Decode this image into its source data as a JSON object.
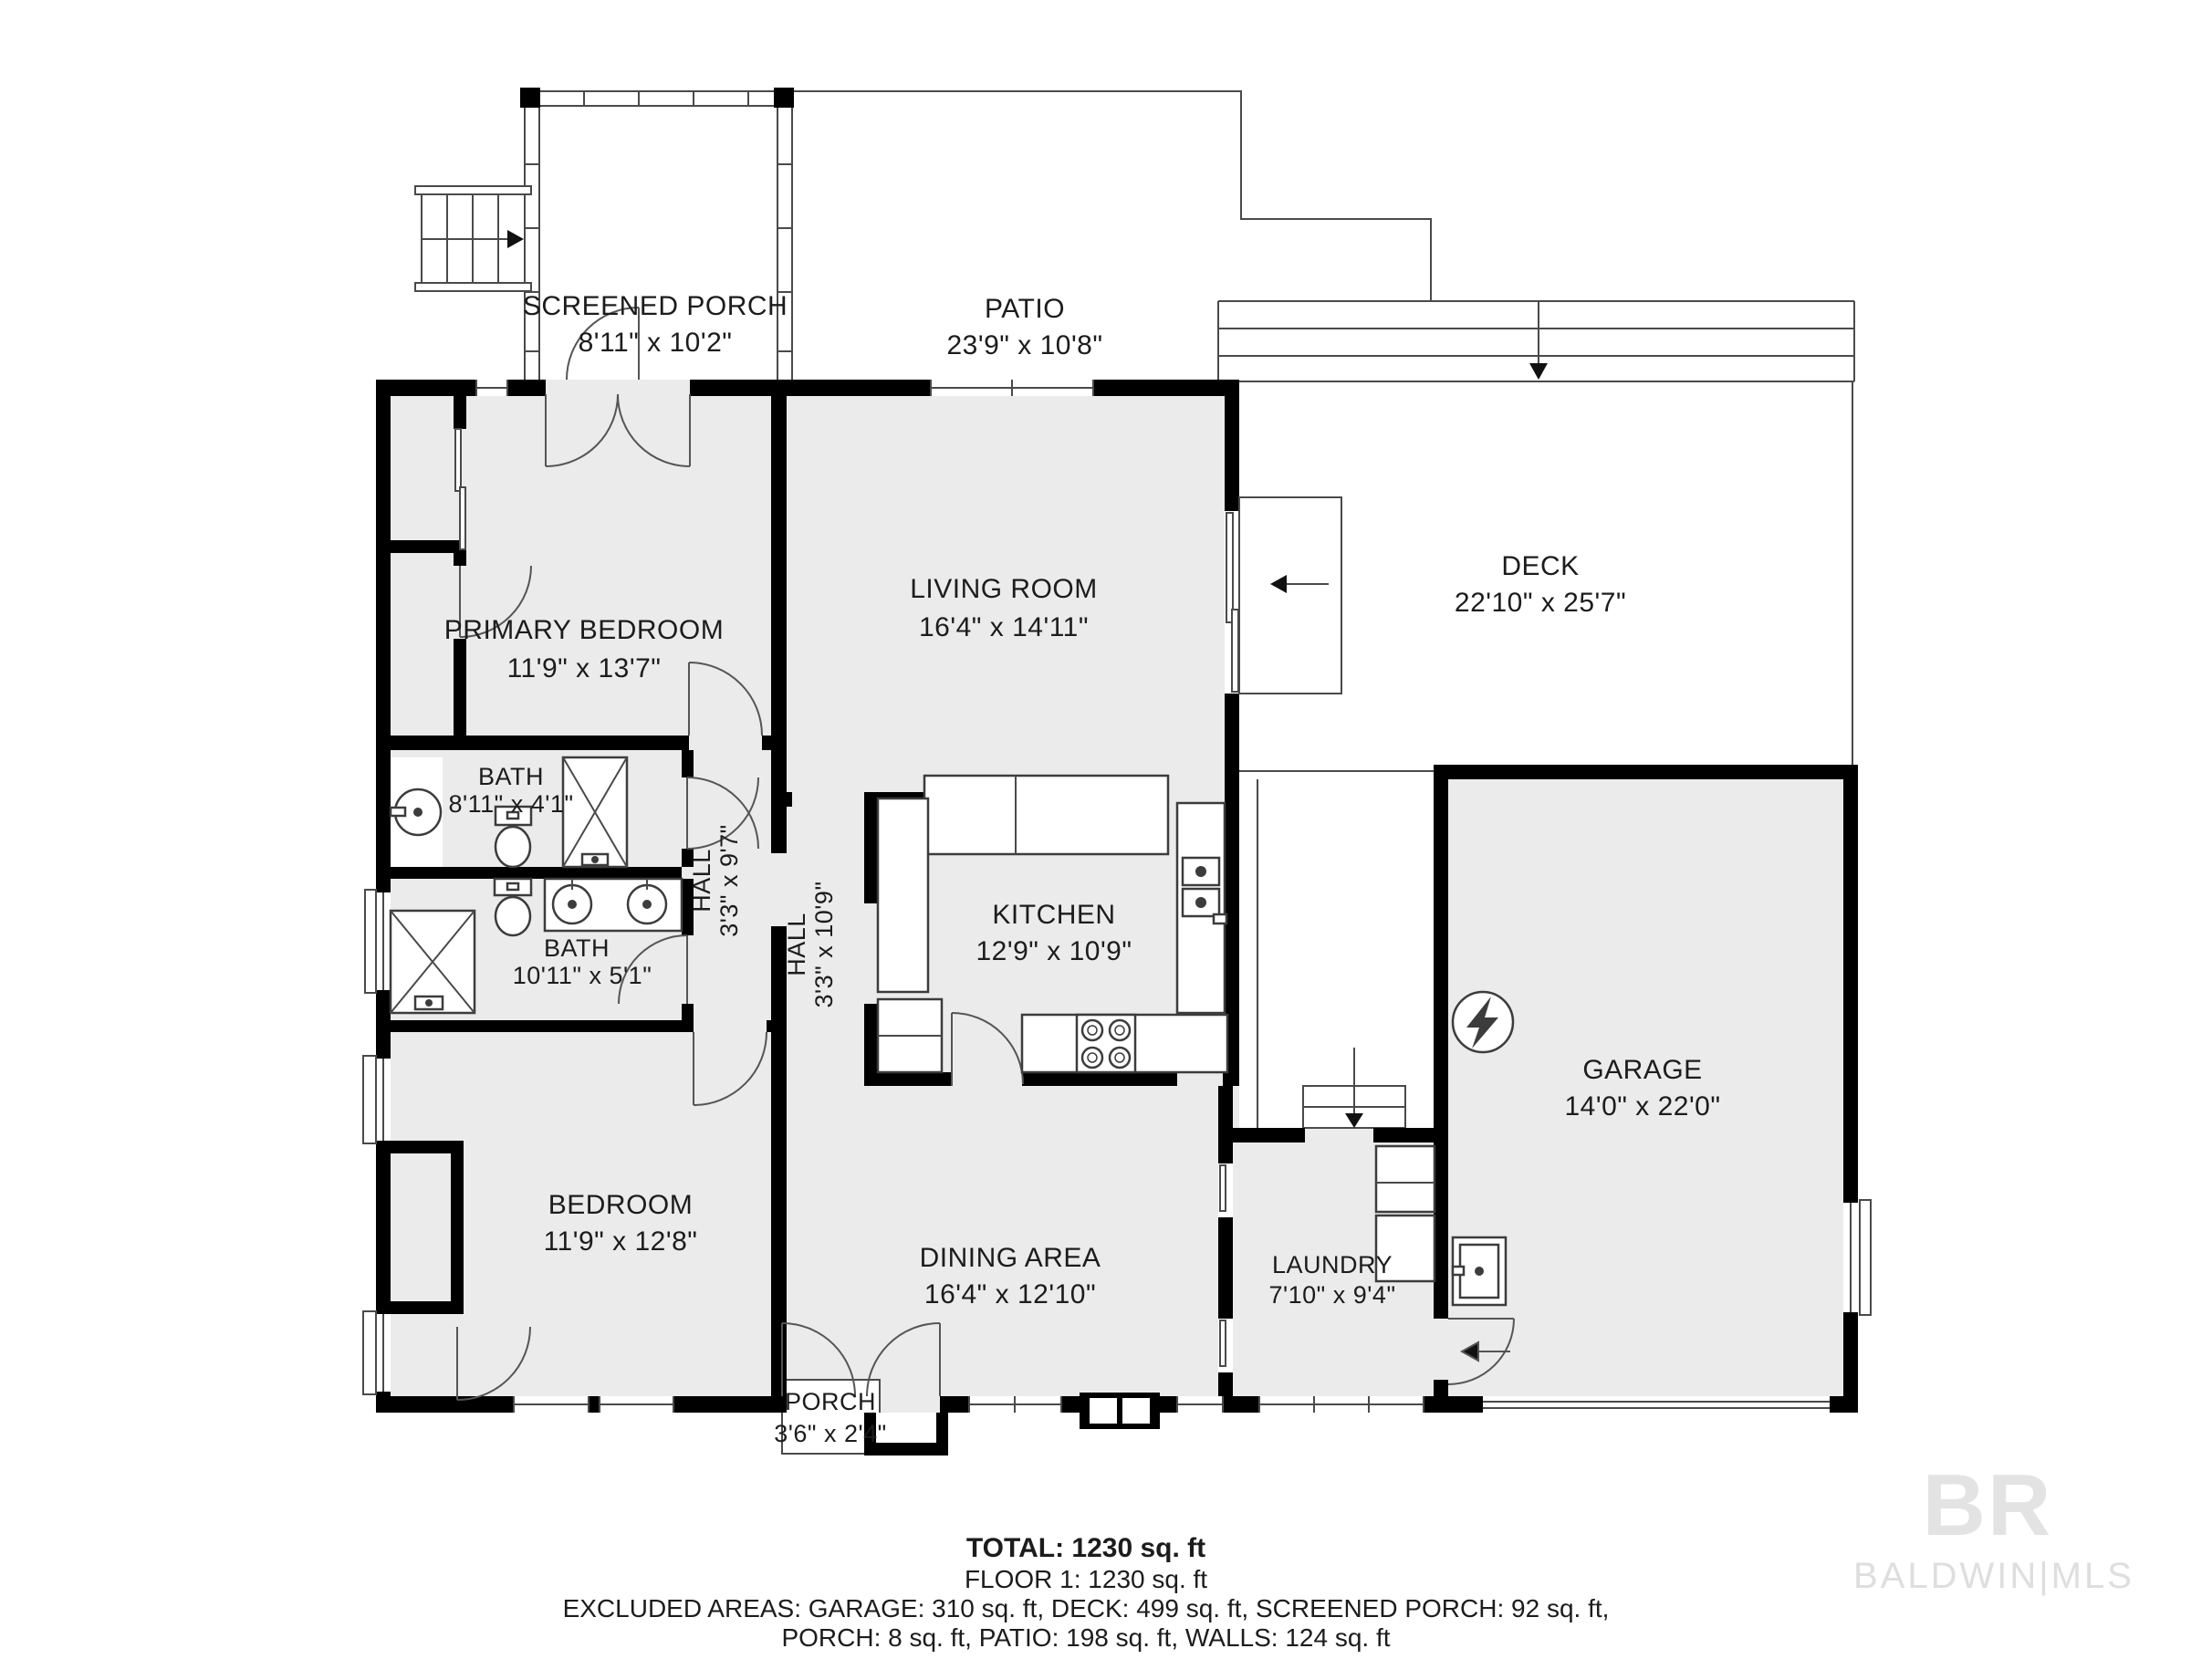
{
  "title": "Floor plan - Floor 1",
  "colors": {
    "wall": "#000000",
    "room_fill": "#ebebeb",
    "line": "#4a4a4a",
    "text": "#1c1c1c",
    "logo": "#e0e0e0",
    "background": "#ffffff"
  },
  "rooms": {
    "screened_porch": {
      "name": "SCREENED PORCH",
      "dims": "8'11\" x 10'2\""
    },
    "patio": {
      "name": "PATIO",
      "dims": "23'9\" x 10'8\""
    },
    "primary_bedroom": {
      "name": "PRIMARY BEDROOM",
      "dims": "11'9\" x 13'7\""
    },
    "living_room": {
      "name": "LIVING ROOM",
      "dims": "16'4\" x 14'11\""
    },
    "deck": {
      "name": "DECK",
      "dims": "22'10\" x 25'7\""
    },
    "bath_top": {
      "name": "BATH",
      "dims": "8'11\" x 4'1\""
    },
    "hall_upper": {
      "name": "HALL",
      "dims": "3'3\" x 9'7\""
    },
    "bath_lower": {
      "name": "BATH",
      "dims": "10'11\" x 5'1\""
    },
    "hall_lower": {
      "name": "HALL",
      "dims": "3'3\" x 10'9\""
    },
    "kitchen": {
      "name": "KITCHEN",
      "dims": "12'9\" x 10'9\""
    },
    "garage": {
      "name": "GARAGE",
      "dims": "14'0\" x 22'0\""
    },
    "bedroom": {
      "name": "BEDROOM",
      "dims": "11'9\" x 12'8\""
    },
    "dining_area": {
      "name": "DINING AREA",
      "dims": "16'4\" x 12'10\""
    },
    "laundry": {
      "name": "LAUNDRY",
      "dims": "7'10\" x 9'4\""
    },
    "porch": {
      "name": "PORCH",
      "dims": "3'6\" x 2'4\""
    }
  },
  "footer": {
    "total": "TOTAL: 1230 sq. ft",
    "floor": "FLOOR 1: 1230 sq. ft",
    "excluded_line1": "EXCLUDED AREAS: GARAGE: 310 sq. ft, DECK: 499 sq. ft, SCREENED PORCH: 92 sq. ft,",
    "excluded_line2": "PORCH: 8 sq. ft, PATIO: 198 sq. ft, WALLS: 124 sq. ft"
  },
  "logo": {
    "monogram": "BR",
    "wordmark": "BALDWIN|MLS"
  }
}
